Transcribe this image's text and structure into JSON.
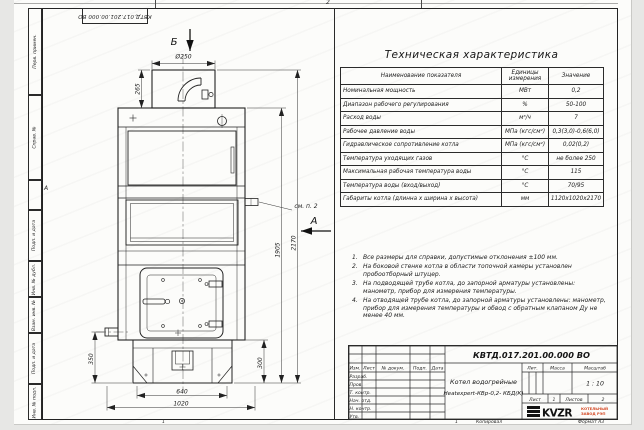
{
  "sheet": {
    "corner_doc_number": "КВТД.017.201.00.000 ВО",
    "zone_top": "2",
    "zone_left": "А",
    "zone_bottom_left": "1",
    "zone_bottom_right": "1",
    "copied_label": "Копировал",
    "format_label": "Формат А3"
  },
  "side_fields": [
    "Перв. примен.",
    "Справ. №",
    "Подп. и дата",
    "Инв. № дубл.",
    "Взам. инв. №",
    "Подп. и дата",
    "Инв. № подл."
  ],
  "spec": {
    "title": "Техническая характеристика",
    "headers": [
      "Наименование показателя",
      "Единицы измерения",
      "Значение"
    ],
    "rows": [
      {
        "name": "Номинальная мощность",
        "unit": "МВт",
        "value": "0,2"
      },
      {
        "name": "Диапазон рабочего регулирования",
        "unit": "%",
        "value": "50-100"
      },
      {
        "name": "Расход воды",
        "unit": "м³/ч",
        "value": "7"
      },
      {
        "name": "Рабочее давление воды",
        "unit": "МПа (кгс/см²)",
        "value": "0,3(3,0)-0,6(6,0)"
      },
      {
        "name": "Гидравлическое сопротивление котла",
        "unit": "МПа (кгс/см²)",
        "value": "0,02(0,2)"
      },
      {
        "name": "Температура уходящих газов",
        "unit": "°С",
        "value": "не более 250"
      },
      {
        "name": "Максимальная рабочая температура воды",
        "unit": "°С",
        "value": "115"
      },
      {
        "name": "Температура воды (вход/выход)",
        "unit": "°С",
        "value": "70/95"
      },
      {
        "name": "Габариты котла (длинна х ширина х высота)",
        "unit": "мм",
        "value": "1120х1020х2170"
      }
    ]
  },
  "notes": [
    {
      "num": "1.",
      "text": "Все размеры для справки, допустимые отклонения ±100 мм."
    },
    {
      "num": "2.",
      "text": "На боковой стенке котла в области топочной камеры установлен пробоотборный штуцер."
    },
    {
      "num": "3.",
      "text": "На подводящей трубе котла, до запорной арматуры установлены: манометр, прибор для измерения температуры."
    },
    {
      "num": "4.",
      "text": "На отводящей трубе котла, до запорной арматуры установлены: манометр, прибор для измерения температуры и обвод с обратным клапаном Ду не менее 40 мм."
    }
  ],
  "drawing": {
    "view_b": "Б",
    "view_a": "А",
    "callout_note2": "см. п. 2",
    "dim_diameter": "Ø250",
    "dim_chimney_h": "265",
    "dim_total_h": "2170",
    "dim_body_h": "1905",
    "dim_pipe_h": "350",
    "dim_base_h": "300",
    "dim_base_w": "640",
    "dim_total_w": "1020"
  },
  "title_block": {
    "doc_number": "КВТД.017.201.00.000 ВО",
    "name_line1": "Котел водогрейные",
    "name_line2": "Heatexpert-КВр-0,2- КБД(К)",
    "col_izm": "Изм.",
    "col_list": "Лист",
    "col_docnum": "№ докум.",
    "col_podp": "Подп.",
    "col_data": "Дата",
    "row_razrab": "Разраб.",
    "row_prov": "Пров.",
    "row_tkontr": "Т. контр.",
    "row_nachotd": "Нач. отд.",
    "row_nkontr": "Н. контр.",
    "row_utv": "Утв.",
    "lit_label": "Лит.",
    "mass_label": "Масса",
    "scale_label": "Масштаб",
    "scale_value": "1 : 10",
    "list_label": "Лист",
    "list_value": "1",
    "listov_label": "Листов",
    "listov_value": "2",
    "logo_text": "KVZR",
    "company_line1": "КОТЕЛЬНЫЙ",
    "company_line2": "ЗАВОД РЭП"
  }
}
